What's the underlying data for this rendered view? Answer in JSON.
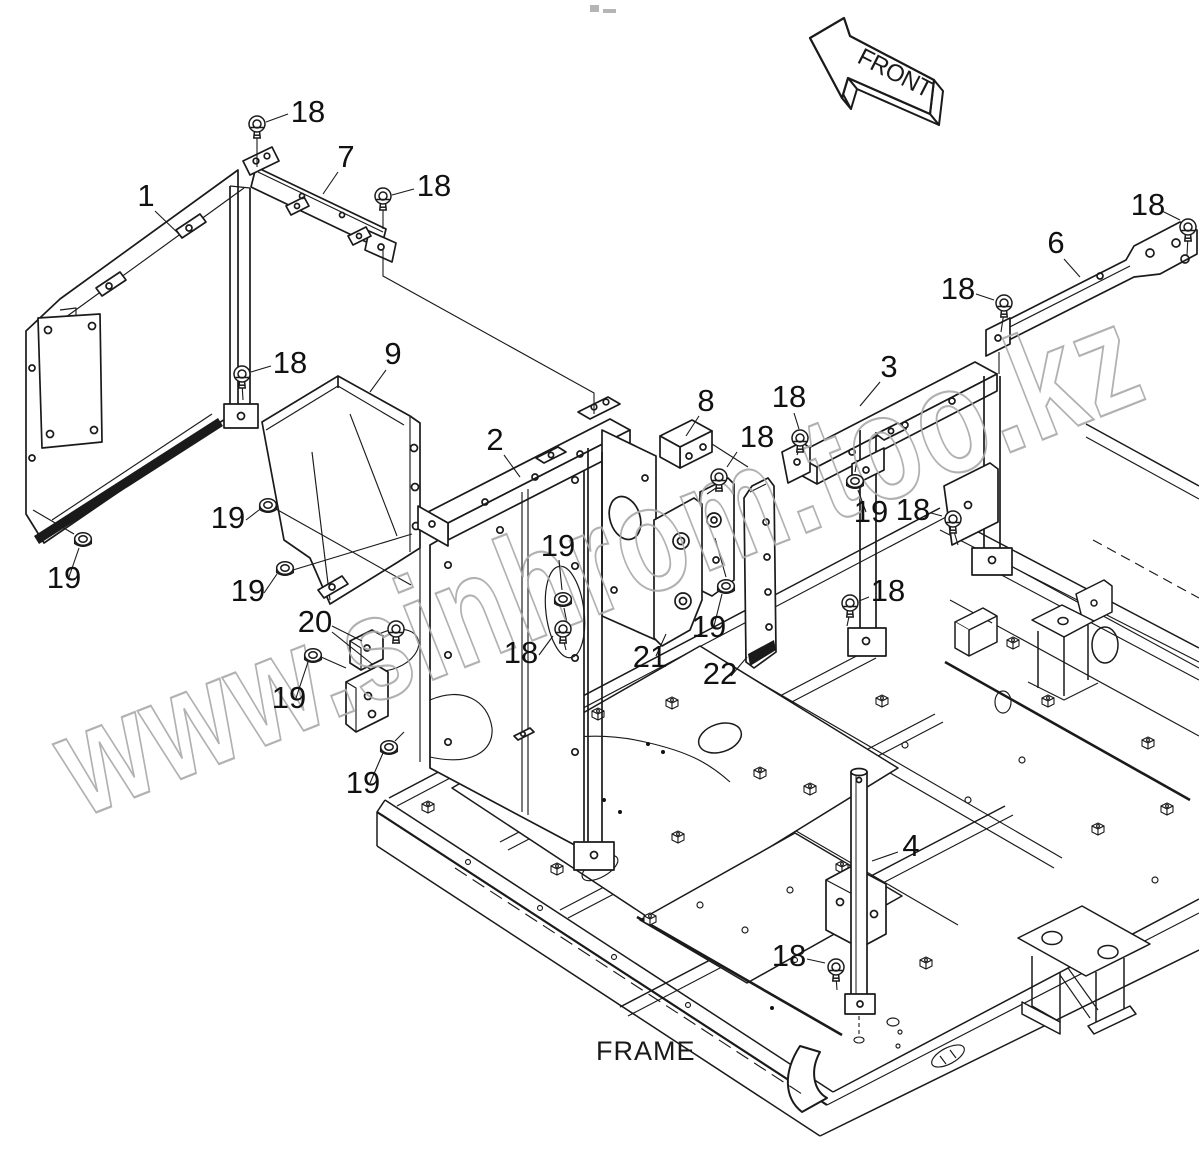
{
  "figure": {
    "front_label": "FRONT",
    "frame_label": "FRAME",
    "watermark_text": "www.sinhrom.too.kz"
  },
  "callouts": [
    {
      "label": "18",
      "x": 308,
      "y": 122,
      "leader": [
        288,
        114,
        266,
        122
      ],
      "fastener": {
        "type": "bolt",
        "x": 257,
        "y": 124
      }
    },
    {
      "label": "7",
      "x": 346,
      "y": 167,
      "leader": [
        338,
        172,
        323,
        194
      ],
      "fastener": null
    },
    {
      "label": "18",
      "x": 434,
      "y": 196,
      "leader": [
        414,
        189,
        392,
        195
      ],
      "fastener": {
        "type": "bolt",
        "x": 383,
        "y": 196
      }
    },
    {
      "label": "1",
      "x": 146,
      "y": 206,
      "leader": [
        155,
        211,
        182,
        237
      ],
      "fastener": null
    },
    {
      "label": "18",
      "x": 1148,
      "y": 215,
      "leader": [
        1162,
        211,
        1180,
        220
      ],
      "fastener": {
        "type": "bolt",
        "x": 1188,
        "y": 227
      }
    },
    {
      "label": "6",
      "x": 1056,
      "y": 253,
      "leader": [
        1064,
        259,
        1080,
        277
      ],
      "fastener": null
    },
    {
      "label": "18",
      "x": 958,
      "y": 299,
      "leader": [
        976,
        294,
        994,
        300
      ],
      "fastener": {
        "type": "bolt",
        "x": 1004,
        "y": 303
      }
    },
    {
      "label": "9",
      "x": 393,
      "y": 364,
      "leader": [
        386,
        370,
        370,
        392
      ],
      "fastener": null
    },
    {
      "label": "18",
      "x": 290,
      "y": 373,
      "leader": [
        271,
        366,
        251,
        372
      ],
      "fastener": {
        "type": "bolt",
        "x": 242,
        "y": 374
      }
    },
    {
      "label": "3",
      "x": 889,
      "y": 377,
      "leader": [
        880,
        382,
        860,
        406
      ],
      "fastener": null
    },
    {
      "label": "8",
      "x": 706,
      "y": 411,
      "leader": [
        699,
        416,
        686,
        436
      ],
      "fastener": null
    },
    {
      "label": "18",
      "x": 789,
      "y": 407,
      "leader": [
        794,
        413,
        799,
        429
      ],
      "fastener": {
        "type": "bolt",
        "x": 800,
        "y": 438
      }
    },
    {
      "label": "18",
      "x": 757,
      "y": 447,
      "leader": [
        737,
        452,
        727,
        467
      ],
      "fastener": {
        "type": "bolt",
        "x": 719,
        "y": 477
      }
    },
    {
      "label": "2",
      "x": 495,
      "y": 450,
      "leader": [
        504,
        455,
        520,
        477
      ],
      "fastener": null
    },
    {
      "label": "19",
      "x": 228,
      "y": 528,
      "leader": [
        246,
        520,
        259,
        510
      ],
      "fastener": {
        "type": "nut",
        "x": 268,
        "y": 505
      }
    },
    {
      "label": "18",
      "x": 913,
      "y": 520,
      "leader": [
        931,
        513,
        942,
        516
      ],
      "fastener": {
        "type": "bolt",
        "x": 953,
        "y": 519
      }
    },
    {
      "label": "19",
      "x": 871,
      "y": 522,
      "leader": [
        866,
        512,
        858,
        490
      ],
      "fastener": {
        "type": "nut",
        "x": 855,
        "y": 481
      }
    },
    {
      "label": "19",
      "x": 558,
      "y": 556,
      "leader": [
        559,
        560,
        562,
        590
      ],
      "fastener": {
        "type": "nut",
        "x": 563,
        "y": 599
      }
    },
    {
      "label": "19",
      "x": 248,
      "y": 601,
      "leader": [
        264,
        593,
        277,
        574
      ],
      "fastener": {
        "type": "nut",
        "x": 285,
        "y": 568
      }
    },
    {
      "label": "18",
      "x": 888,
      "y": 601,
      "leader": [
        869,
        597,
        859,
        601
      ],
      "fastener": {
        "type": "bolt",
        "x": 850,
        "y": 603
      }
    },
    {
      "label": "20",
      "x": 315,
      "y": 632,
      "leader": [
        332,
        626,
        362,
        641
      ],
      "leader2": [
        332,
        632,
        372,
        664
      ],
      "fastener": null
    },
    {
      "label": "18",
      "x": 521,
      "y": 663,
      "leader": [
        539,
        655,
        553,
        636
      ],
      "fastener": {
        "type": "bolt",
        "x": 563,
        "y": 629
      }
    },
    {
      "label": "21",
      "x": 650,
      "y": 667,
      "leader": [
        656,
        656,
        666,
        634
      ],
      "fastener": null
    },
    {
      "label": "19",
      "x": 709,
      "y": 637,
      "leader": [
        714,
        626,
        722,
        594
      ],
      "fastener": {
        "type": "nut",
        "x": 726,
        "y": 586
      }
    },
    {
      "label": "22",
      "x": 720,
      "y": 684,
      "leader": [
        731,
        676,
        747,
        657
      ],
      "fastener": null
    },
    {
      "label": "19",
      "x": 289,
      "y": 708,
      "leader": [
        296,
        698,
        308,
        662
      ],
      "fastener": {
        "type": "nut",
        "x": 313,
        "y": 655
      }
    },
    {
      "label": "19",
      "x": 363,
      "y": 793,
      "leader": [
        370,
        783,
        383,
        753
      ],
      "fastener": {
        "type": "nut",
        "x": 389,
        "y": 747
      }
    },
    {
      "label": "4",
      "x": 911,
      "y": 856,
      "leader": [
        898,
        852,
        872,
        861
      ],
      "fastener": null
    },
    {
      "label": "18",
      "x": 789,
      "y": 966,
      "leader": [
        807,
        959,
        825,
        963
      ],
      "fastener": {
        "type": "bolt",
        "x": 836,
        "y": 967
      }
    },
    {
      "label": "19",
      "x": 64,
      "y": 588,
      "leader": [
        69,
        577,
        79,
        548
      ],
      "fastener": {
        "type": "nut",
        "x": 83,
        "y": 539
      }
    }
  ]
}
